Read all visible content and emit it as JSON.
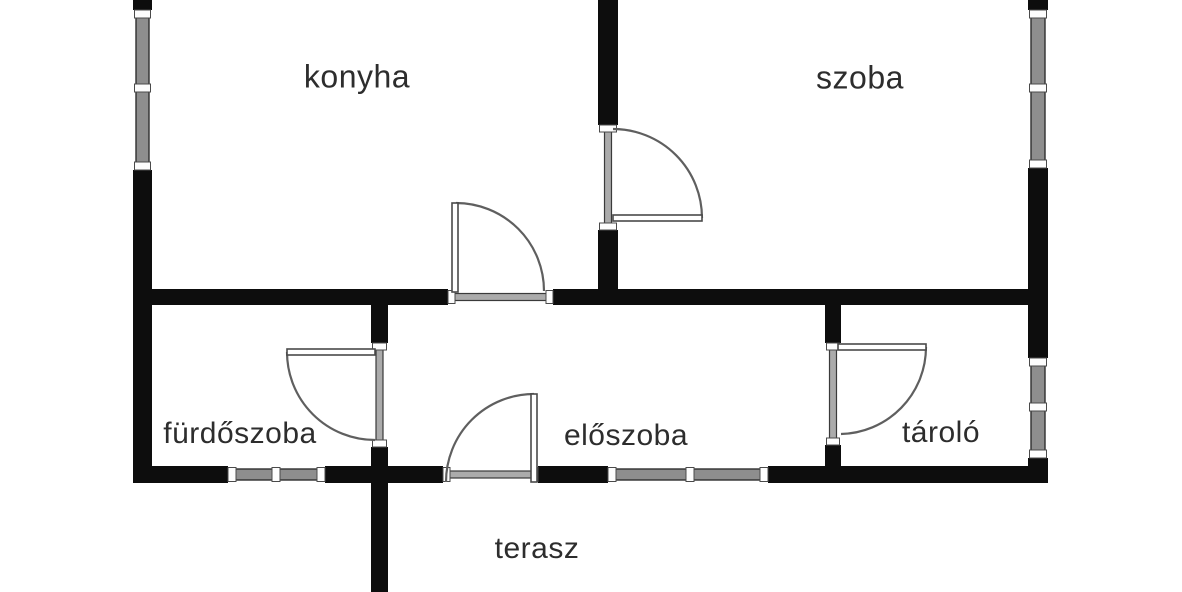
{
  "title": "apartment floor plan",
  "colors": {
    "background": "#ffffff",
    "wall": "#0d0d0d",
    "window_fill": "#8e8e8e",
    "window_edge": "#2f2f2f",
    "sill_fill": "#ababab",
    "sill_edge": "#3a3a3a",
    "jamb_fill": "#fdfdfd",
    "jamb_edge": "#4a4a4a",
    "door_arc": "#5f5f5f",
    "door_leaf_fill": "#ffffff",
    "door_leaf_edge": "#4a4a4a",
    "label": "#2d2d2d"
  },
  "rooms": [
    {
      "id": "konyha",
      "label": "konyha",
      "cx": 357,
      "cy": 77,
      "fs": 32
    },
    {
      "id": "szoba",
      "label": "szoba",
      "cx": 860,
      "cy": 78,
      "fs": 32
    },
    {
      "id": "furdoszoba",
      "label": "fürdőszoba",
      "cx": 240,
      "cy": 434,
      "fs": 30
    },
    {
      "id": "eloszoba",
      "label": "előszoba",
      "cx": 626,
      "cy": 436,
      "fs": 30
    },
    {
      "id": "tarolo",
      "label": "tároló",
      "cx": 941,
      "cy": 433,
      "fs": 30
    },
    {
      "id": "terasz",
      "label": "terasz",
      "cx": 537,
      "cy": 549,
      "fs": 30
    }
  ],
  "geometry": {
    "canvas": {
      "w": 1182,
      "h": 592
    },
    "walls": [
      {
        "x": 133,
        "y": 0,
        "w": 19,
        "h": 10
      },
      {
        "x": 133,
        "y": 170,
        "w": 19,
        "h": 313
      },
      {
        "x": 1028,
        "y": 0,
        "w": 20,
        "h": 10
      },
      {
        "x": 1028,
        "y": 168,
        "w": 20,
        "h": 190
      },
      {
        "x": 1028,
        "y": 458,
        "w": 20,
        "h": 25
      },
      {
        "x": 598,
        "y": 0,
        "w": 20,
        "h": 125
      },
      {
        "x": 598,
        "y": 230,
        "w": 20,
        "h": 75
      },
      {
        "x": 133,
        "y": 289,
        "w": 315,
        "h": 16
      },
      {
        "x": 553,
        "y": 289,
        "w": 495,
        "h": 16
      },
      {
        "x": 371,
        "y": 305,
        "w": 17,
        "h": 40
      },
      {
        "x": 371,
        "y": 447,
        "w": 17,
        "h": 145
      },
      {
        "x": 825,
        "y": 305,
        "w": 16,
        "h": 40
      },
      {
        "x": 825,
        "y": 445,
        "w": 16,
        "h": 38
      },
      {
        "x": 133,
        "y": 466,
        "w": 95,
        "h": 17
      },
      {
        "x": 325,
        "y": 466,
        "w": 118,
        "h": 17
      },
      {
        "x": 538,
        "y": 466,
        "w": 70,
        "h": 17
      },
      {
        "x": 768,
        "y": 466,
        "w": 280,
        "h": 17
      }
    ],
    "windows": [
      {
        "o": "v",
        "x": 133,
        "t": 19,
        "a": 10,
        "b": 170,
        "div": [
          88
        ]
      },
      {
        "o": "v",
        "x": 1028,
        "t": 20,
        "a": 10,
        "b": 168,
        "div": [
          88
        ]
      },
      {
        "o": "v",
        "x": 1028,
        "t": 20,
        "a": 358,
        "b": 458,
        "div": [
          407
        ]
      },
      {
        "o": "h",
        "y": 466,
        "t": 17,
        "a": 228,
        "b": 325,
        "div": [
          276
        ]
      },
      {
        "o": "h",
        "y": 466,
        "t": 17,
        "a": 608,
        "b": 768,
        "div": [
          690
        ]
      }
    ],
    "door_sills": [
      {
        "o": "h",
        "y": 289,
        "t": 16,
        "a": 448,
        "b": 553
      },
      {
        "o": "v",
        "x": 598,
        "t": 20,
        "a": 125,
        "b": 230
      },
      {
        "o": "v",
        "x": 371,
        "t": 17,
        "a": 343,
        "b": 447
      },
      {
        "o": "v",
        "x": 825,
        "t": 16,
        "a": 343,
        "b": 445
      },
      {
        "o": "h",
        "y": 466,
        "t": 17,
        "a": 443,
        "b": 538
      }
    ],
    "doors": [
      {
        "name": "konyha-door",
        "leaf": {
          "x": 452,
          "y": 203,
          "w": 6,
          "h": 89
        },
        "arc": "M 456 203 A 88 88 0 0 1 544 291"
      },
      {
        "name": "szoba-door",
        "leaf": {
          "x": 613,
          "y": 215,
          "w": 89,
          "h": 6
        },
        "arc": "M 613 129 A 89 89 0 0 1 702 218"
      },
      {
        "name": "furdoszoba-door",
        "leaf": {
          "x": 287,
          "y": 349,
          "w": 88,
          "h": 6
        },
        "arc": "M 287 352 A 88 88 0 0 0 375 440"
      },
      {
        "name": "tarolo-door",
        "leaf": {
          "x": 838,
          "y": 344,
          "w": 88,
          "h": 6
        },
        "arc": "M 926 347 A 87 87 0 0 1 841 434"
      },
      {
        "name": "entrance-door",
        "leaf": {
          "x": 531,
          "y": 394,
          "w": 6,
          "h": 88
        },
        "arc": "M 534 394 A 88 88 0 0 0 446 482"
      }
    ]
  }
}
